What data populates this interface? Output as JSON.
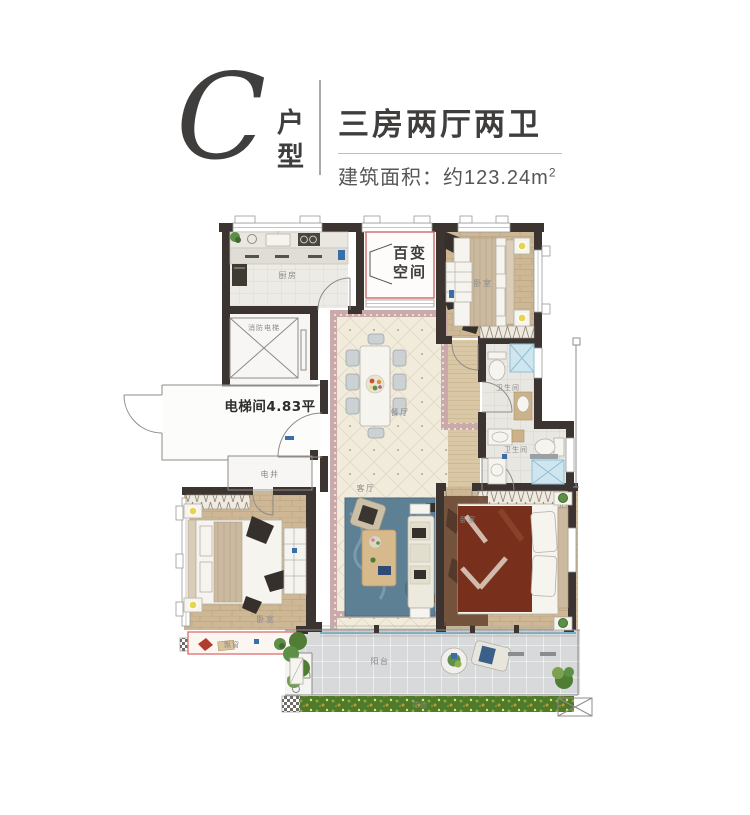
{
  "header": {
    "type_letter": "C",
    "type_suffix": "户型",
    "title": "三房两厅两卫",
    "area_prefix": "建筑面积：约123.24m",
    "area_superscript": "2"
  },
  "plan": {
    "labels": {
      "kitchen": "厨房",
      "flex_space_line1": "百变",
      "flex_space_line2": "空间",
      "bedroom": "卧室",
      "fire_elevator": "消防电梯",
      "bathroom": "卫生间",
      "elevator_hall": "电梯间4.83平",
      "dining": "餐厅",
      "utility_shaft": "电井",
      "living": "客厅",
      "bay_window": "飘窗",
      "balcony": "阳台",
      "flower_bed": "花池"
    }
  },
  "colors": {
    "wall": "#3b3430",
    "accent_red": "#e07878",
    "flex_outline_red": "#c96a6a",
    "floor_cream": "#f1ebdb",
    "floor_wood": "#cdb794",
    "mosaic_band": "#c9a9a9",
    "rug_blue": "#5e8095",
    "blanket_red": "#78301c",
    "balcony_tile": "#d7d9da",
    "planter_green": "#4e7a2c",
    "shower_blue": "#cfe6ef",
    "railing_blue": "#74aed0",
    "text_dark": "#3f3e3c",
    "text_gray": "#8b8b8b"
  }
}
